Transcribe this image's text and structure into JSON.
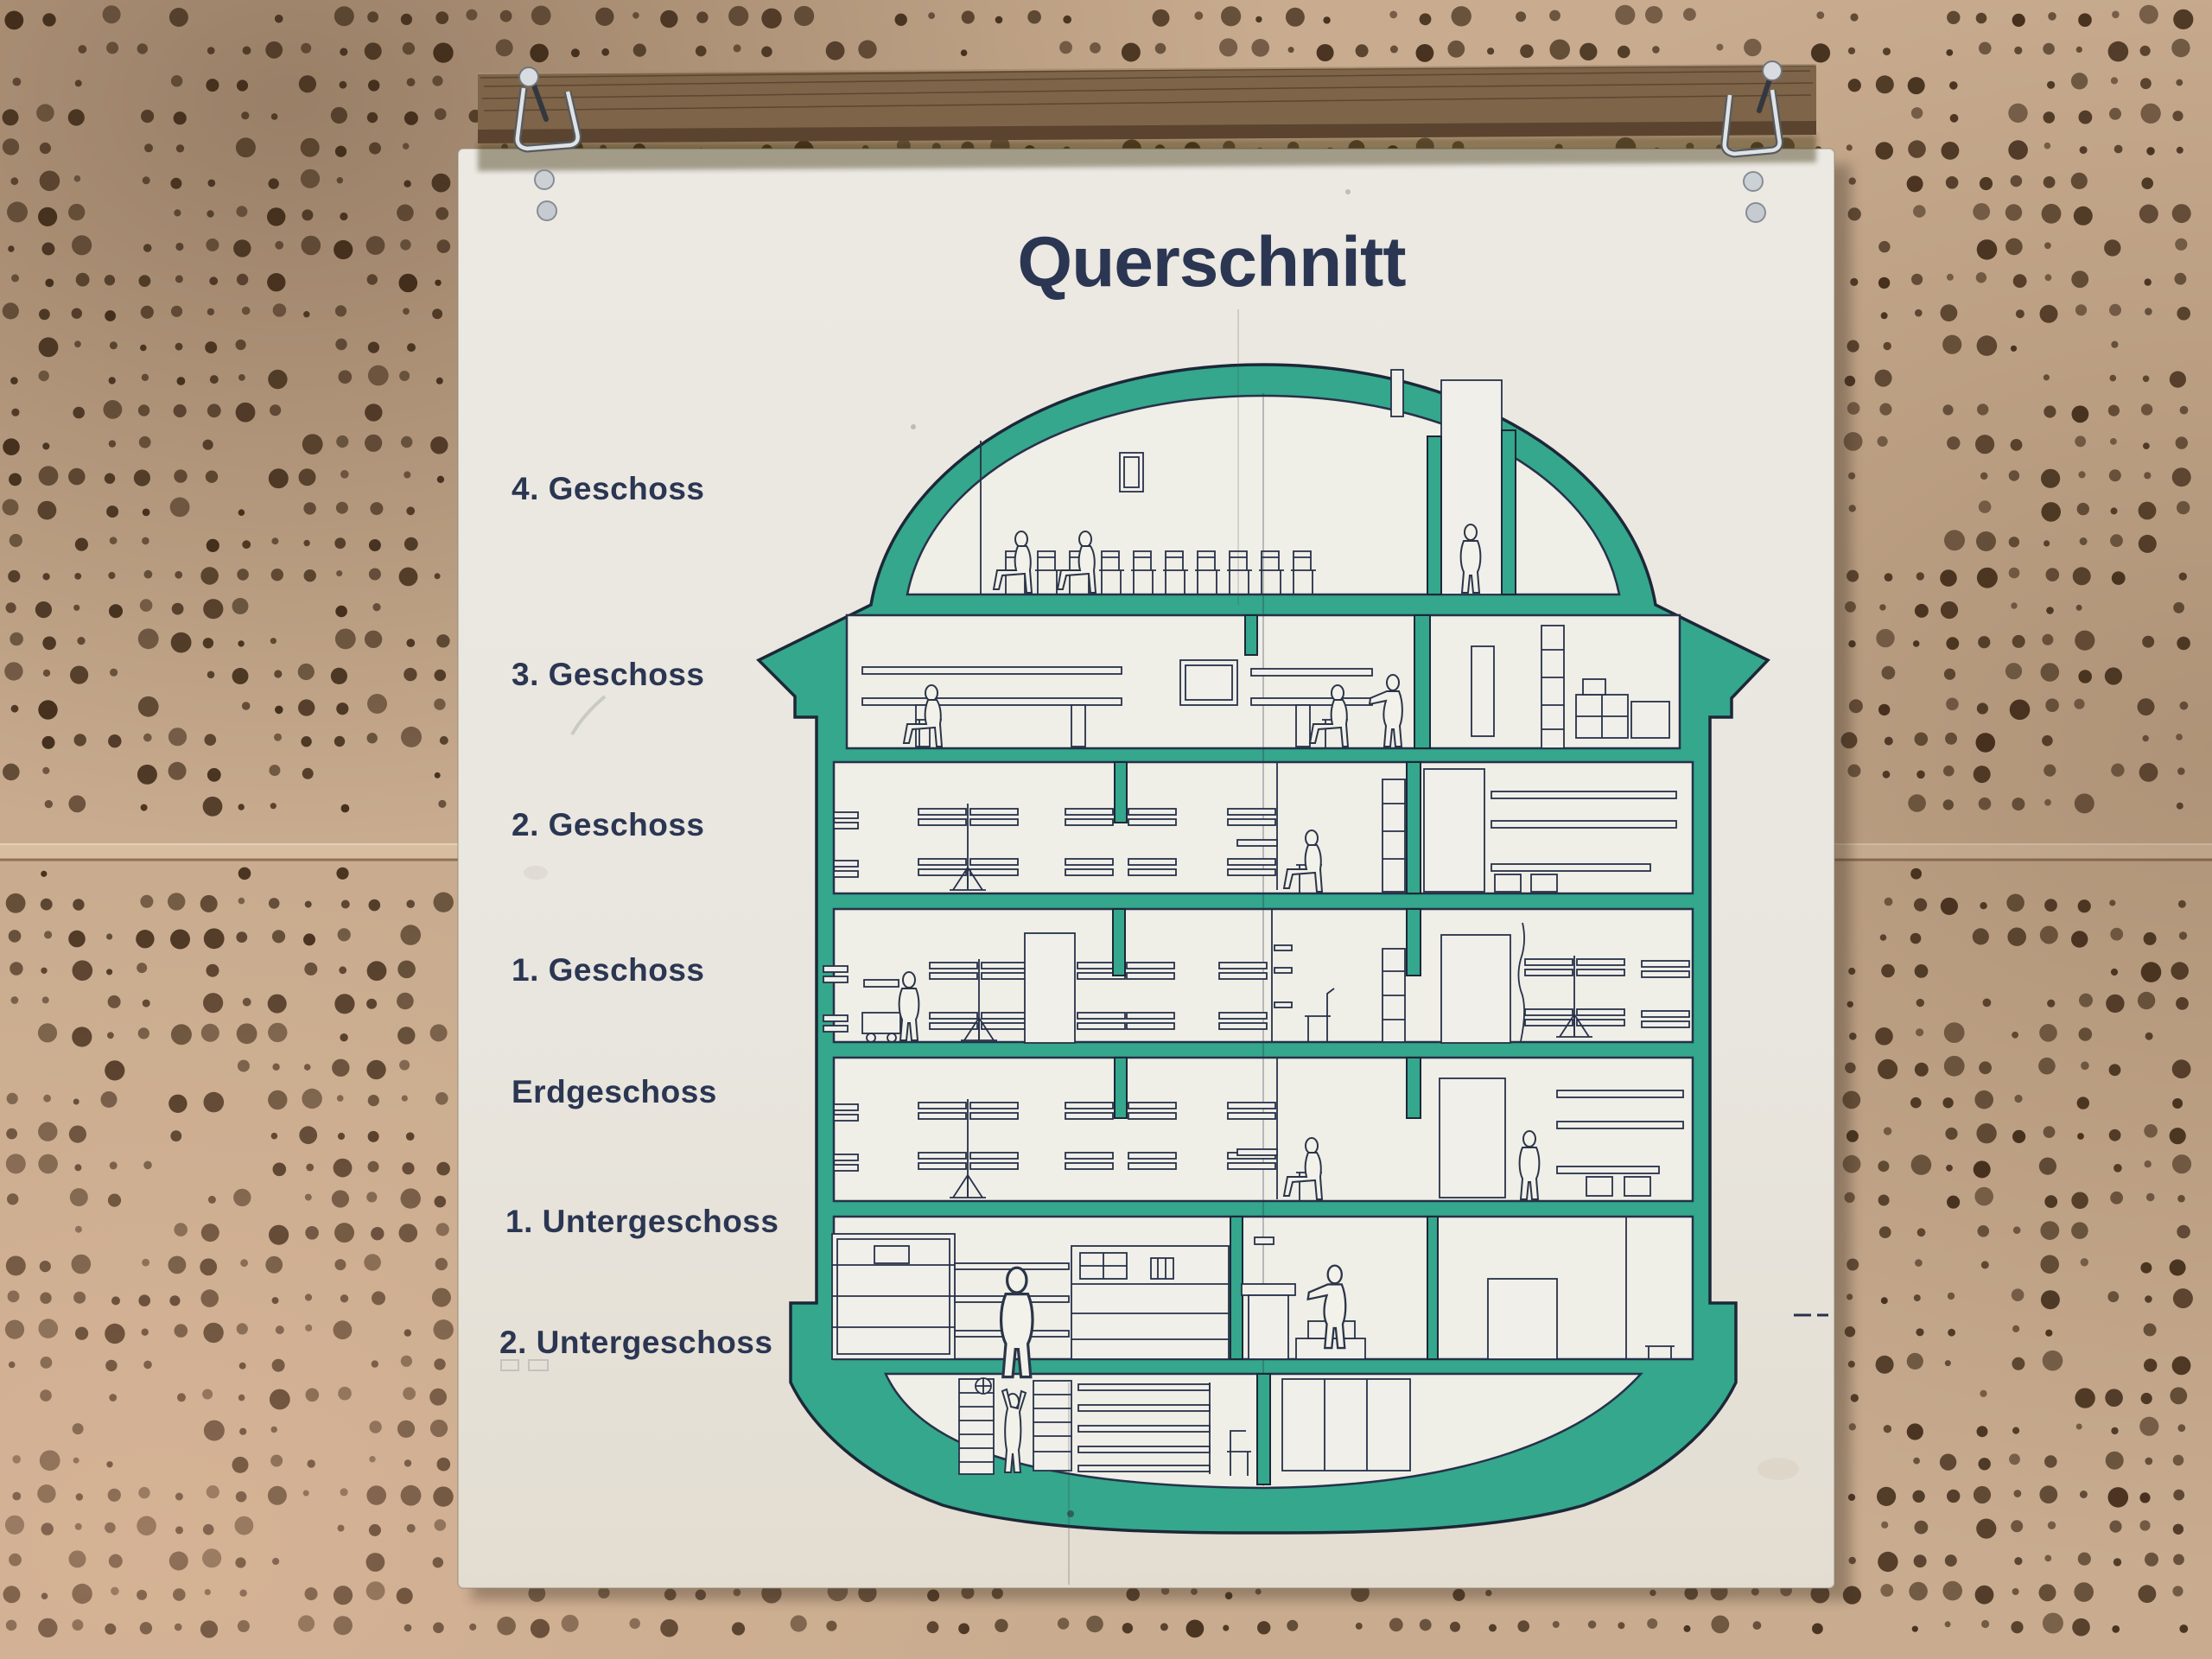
{
  "poster": {
    "title": "Querschnitt",
    "floor_labels": [
      "4. Geschoss",
      "3. Geschoss",
      "2. Geschoss",
      "1. Geschoss",
      "Erdgeschoss",
      "1. Untergeschoss",
      "2. Untergeschoss"
    ]
  },
  "colors": {
    "wall_panel": "#c9ac8f",
    "panel_hole": "#3a2512",
    "wood_rail": "#7e6449",
    "poster_background": "#eae7e0",
    "diagram_green": "#34a78c",
    "ink_navy": "#273149",
    "text_navy": "#2b3652",
    "metal": "#d8dce0"
  }
}
